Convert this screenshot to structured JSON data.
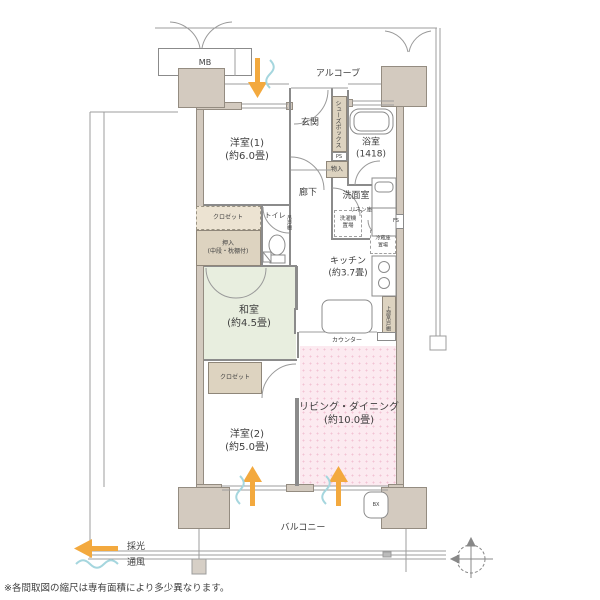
{
  "plan_type": "apartment-floor-plan",
  "rooms": {
    "yoshitsu1": "洋室(1)\n(約6.0畳)",
    "yoshitsu2": "洋室(2)\n(約5.0畳)",
    "washitsu": "和室\n(約4.5畳)",
    "living_dining": "リビング・ダイニング\n(約10.0畳)",
    "kitchen": "キッチン\n(約3.7畳)",
    "bath": "浴室\n(1418)",
    "genkan": "玄関",
    "rouka": "廊下",
    "senmenshitsu": "洗面室",
    "toilet": "トイレ",
    "balcony": "バルコニー",
    "alcove": "アルコーブ"
  },
  "fixtures": {
    "mb": "MB",
    "shoes_box": "シューズボックス",
    "ps": "PS",
    "monoire": "物入",
    "laundry": "洗濯機\n置場",
    "linen": "リネン庫",
    "fs": "FS",
    "tsuridana": "吊戸棚",
    "closet1": "クロゼット",
    "oshiire": "押入\n(中段・枕棚付)",
    "fridge": "冷蔵庫\n置場",
    "upper_cabinet": "上部吊戸棚",
    "counter": "カウンター",
    "closet2": "クロゼット",
    "bx": "BX"
  },
  "legend": {
    "daylight": "採光",
    "ventilation": "通風"
  },
  "footnote": "※各間取図の縮尺は専有面積により多少異なります。",
  "colors": {
    "pillar_beige": "#d3cabf",
    "storage_tan": "#ddd3c0",
    "tatami_green": "#e8eedf",
    "living_pink": "#fceaf0",
    "daylight_orange": "#f3a93e",
    "ventilation_blue": "#a5d6de",
    "wall_gray": "#8b8b8b"
  }
}
